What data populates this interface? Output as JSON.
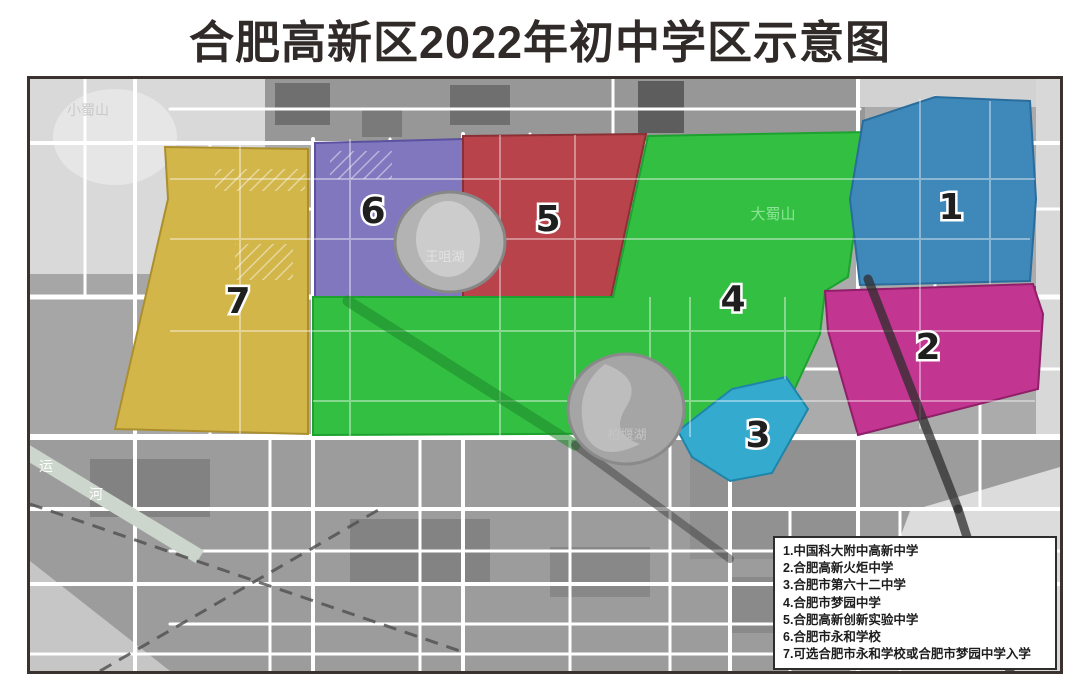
{
  "title": "合肥高新区2022年初中学区示意图",
  "legend": {
    "items": [
      "1.中国科大附中高新中学",
      "2.合肥高新火炬中学",
      "3.合肥市第六十二中学",
      "4.合肥市梦园中学",
      "5.合肥高新创新实验中学",
      "6.合肥市永和学校",
      "7.可选合肥市永和学校或合肥市梦园中学入学"
    ]
  },
  "map": {
    "zones": [
      {
        "number": "1",
        "school": "中国科大附中高新中学",
        "color": "#3e88ba",
        "border": "#2a6d9c"
      },
      {
        "number": "2",
        "school": "合肥高新火炬中学",
        "color": "#c23591",
        "border": "#8f1f68"
      },
      {
        "number": "3",
        "school": "合肥市第六十二中学",
        "color": "#35aacf",
        "border": "#1f85a8"
      },
      {
        "number": "4",
        "school": "合肥市梦园中学",
        "color": "#33bf42",
        "border": "#1da12f"
      },
      {
        "number": "5",
        "school": "合肥高新创新实验中学",
        "color": "#b8434a",
        "border": "#8c2f35"
      },
      {
        "number": "6",
        "school": "合肥市永和学校",
        "color": "#8077be",
        "border": "#5b51a0"
      },
      {
        "number": "7",
        "school": "可选合肥市永和学校或合肥市梦园中学入学",
        "color": "#d2b64a",
        "border": "#ab8f2f"
      }
    ],
    "landmarks": {
      "xiaoshushan": "小蜀山",
      "dashushan": "大蜀山",
      "wangzuihu": "王咀湖",
      "baiyanhu": "柏堰湖",
      "canal_char1": "运",
      "canal_char2": "河"
    }
  }
}
